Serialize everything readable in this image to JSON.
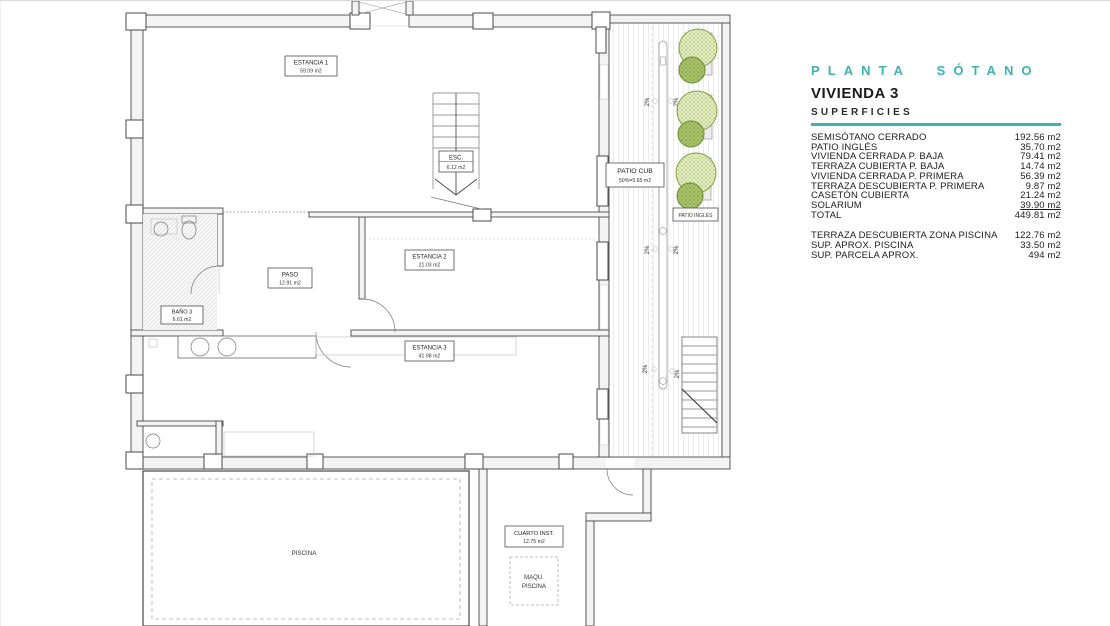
{
  "panel": {
    "plan_title": "PLANTA SÓTANO",
    "unit_title": "VIVIENDA 3",
    "subtitle": "SUPERFICIES",
    "accent_color": "#3fb3ab",
    "rows": [
      {
        "label": "SEMISÓTANO CERRADO",
        "value": "192.56 m2"
      },
      {
        "label": "PATIO INGLÉS",
        "value": "35.70 m2"
      },
      {
        "label": "VIVIENDA CERRADA P. BAJA",
        "value": "79.41 m2"
      },
      {
        "label": "TERRAZA CUBIERTA P. BAJA",
        "value": "14.74 m2"
      },
      {
        "label": "VIVIENDA CERRADA P. PRIMERA",
        "value": "56.39 m2"
      },
      {
        "label": "TERRAZA DESCUBIERTA P. PRIMERA",
        "value": "9.87 m2"
      },
      {
        "label": "CASETÓN CUBIERTA",
        "value": "21.24 m2"
      },
      {
        "label": "SOLARIUM",
        "value": "39.90 m2"
      },
      {
        "label": "TOTAL",
        "value": "449.81 m2"
      }
    ],
    "extra_rows": [
      {
        "label": "TERRAZA DESCUBIERTA  ZONA PISCINA",
        "value": "122.76 m2"
      },
      {
        "label": "SUP.  APROX.  PISCINA",
        "value": "33.50 m2"
      },
      {
        "label": "SUP. PARCELA APROX.",
        "value": "494 m2"
      }
    ]
  },
  "plan": {
    "labels": {
      "estancia1": {
        "name": "ESTANCIA 1",
        "area": "59.09 m2"
      },
      "esc": {
        "name": "ESC.",
        "area": "6.12 m2"
      },
      "patio_cub": {
        "name": "PATIO CUB",
        "area": "50%=5.65 m2"
      },
      "patio_ingles": {
        "name": "PATIO INGLÉS"
      },
      "paso": {
        "name": "PASO",
        "area": "12.91 m2"
      },
      "estancia2": {
        "name": "ESTANCIA 2",
        "area": "21.03 m2"
      },
      "bano3": {
        "name": "BAÑO 3",
        "area": "6.61 m2"
      },
      "estancia3": {
        "name": "ESTANCIA 3",
        "area": "41.98 m2"
      },
      "piscina": {
        "name": "PISCINA"
      },
      "cuarto_inst": {
        "name": "CUARTO INST.",
        "area": "12.75 m2"
      },
      "maqu_piscina": {
        "line1": "MAQU.",
        "line2": "PISCINA"
      },
      "slope": "2%"
    }
  }
}
